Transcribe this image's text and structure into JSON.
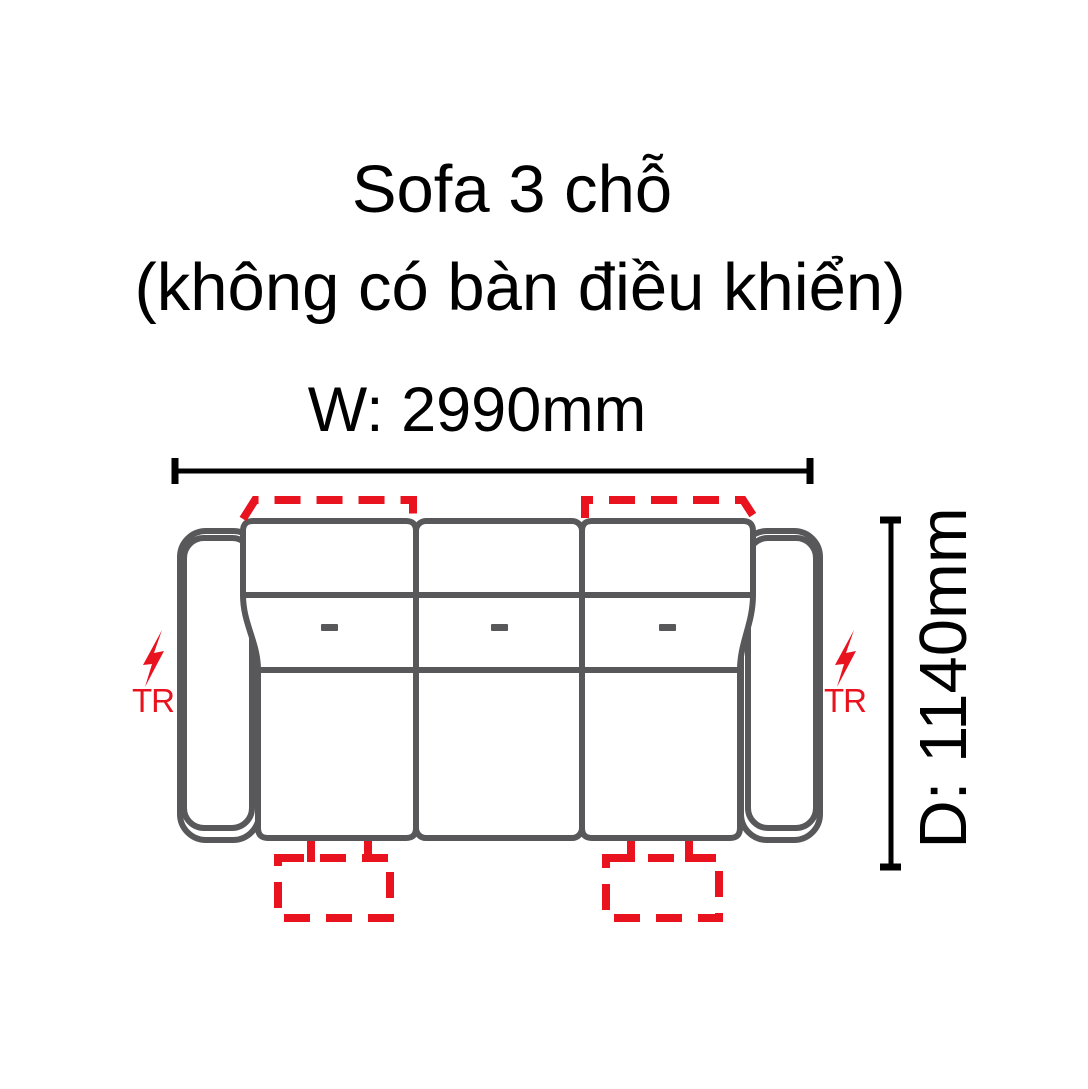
{
  "title": {
    "line1": "Sofa 3 chỗ",
    "line2": "(không có bàn điều khiển)"
  },
  "dimensions": {
    "width_label": "W: 2990mm",
    "width_mm": 2990,
    "depth_label": "D: 1140mm",
    "depth_mm": 1140
  },
  "sofa": {
    "type": "3-seat sofa top view",
    "seat_count": 3,
    "recliner_left_label": "TR",
    "recliner_right_label": "TR",
    "markers": {
      "headrest_dashed_outlines": 2,
      "footrest_dashed_outlines": 2,
      "lightning_bolt_icons": 2
    }
  },
  "colors": {
    "outline_gray": "#58585B",
    "accent_red": "#E8131E",
    "text_black": "#000000",
    "background": "#FFFFFF"
  }
}
